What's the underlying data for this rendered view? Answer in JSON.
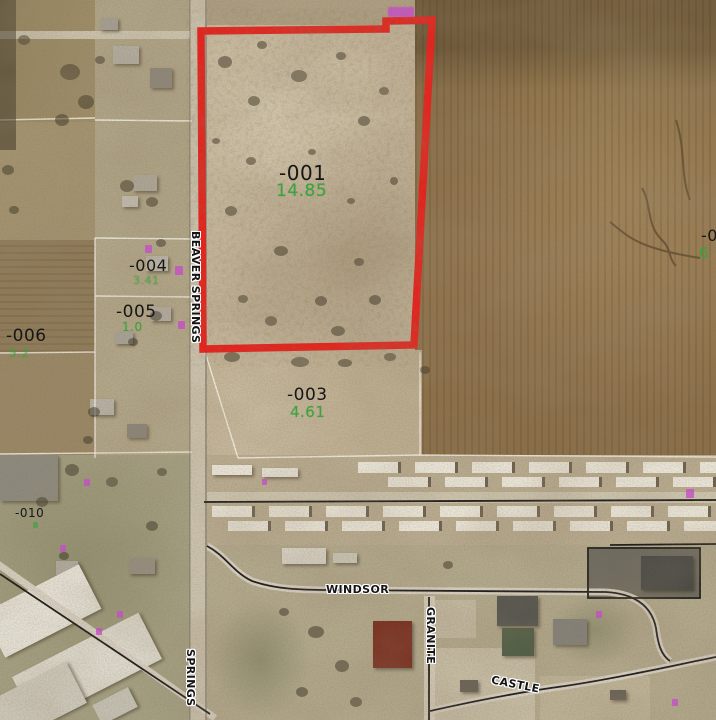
{
  "parcels": {
    "p001": {
      "id": "-001",
      "acreage": "14.85"
    },
    "p003": {
      "id": "-003",
      "acreage": "4.61"
    },
    "p004": {
      "id": "-004",
      "acreage": "3.41"
    },
    "p005": {
      "id": "-005",
      "acreage": "1.0"
    },
    "p006": {
      "id": "-006",
      "acreage": "5.2"
    },
    "p010": {
      "id": "-010"
    },
    "p_edge": {
      "id": "-0",
      "acreage": "6"
    }
  },
  "streets": {
    "windsor": "WINDSOR",
    "granite": "GRANITE",
    "castle": "CASTLE",
    "beaver_springs": "BEAVER SPRINGS",
    "springs": "SPRINGS"
  },
  "colors": {
    "selection_outline": "#e8211c",
    "parcel_id_text": "#161616",
    "acreage_text": "#3da33d",
    "street_label_text": "#141414",
    "street_label_halo": "#ffffff",
    "annotation_pink": "#c44fc4",
    "annotation_green": "#4f9e4f"
  }
}
